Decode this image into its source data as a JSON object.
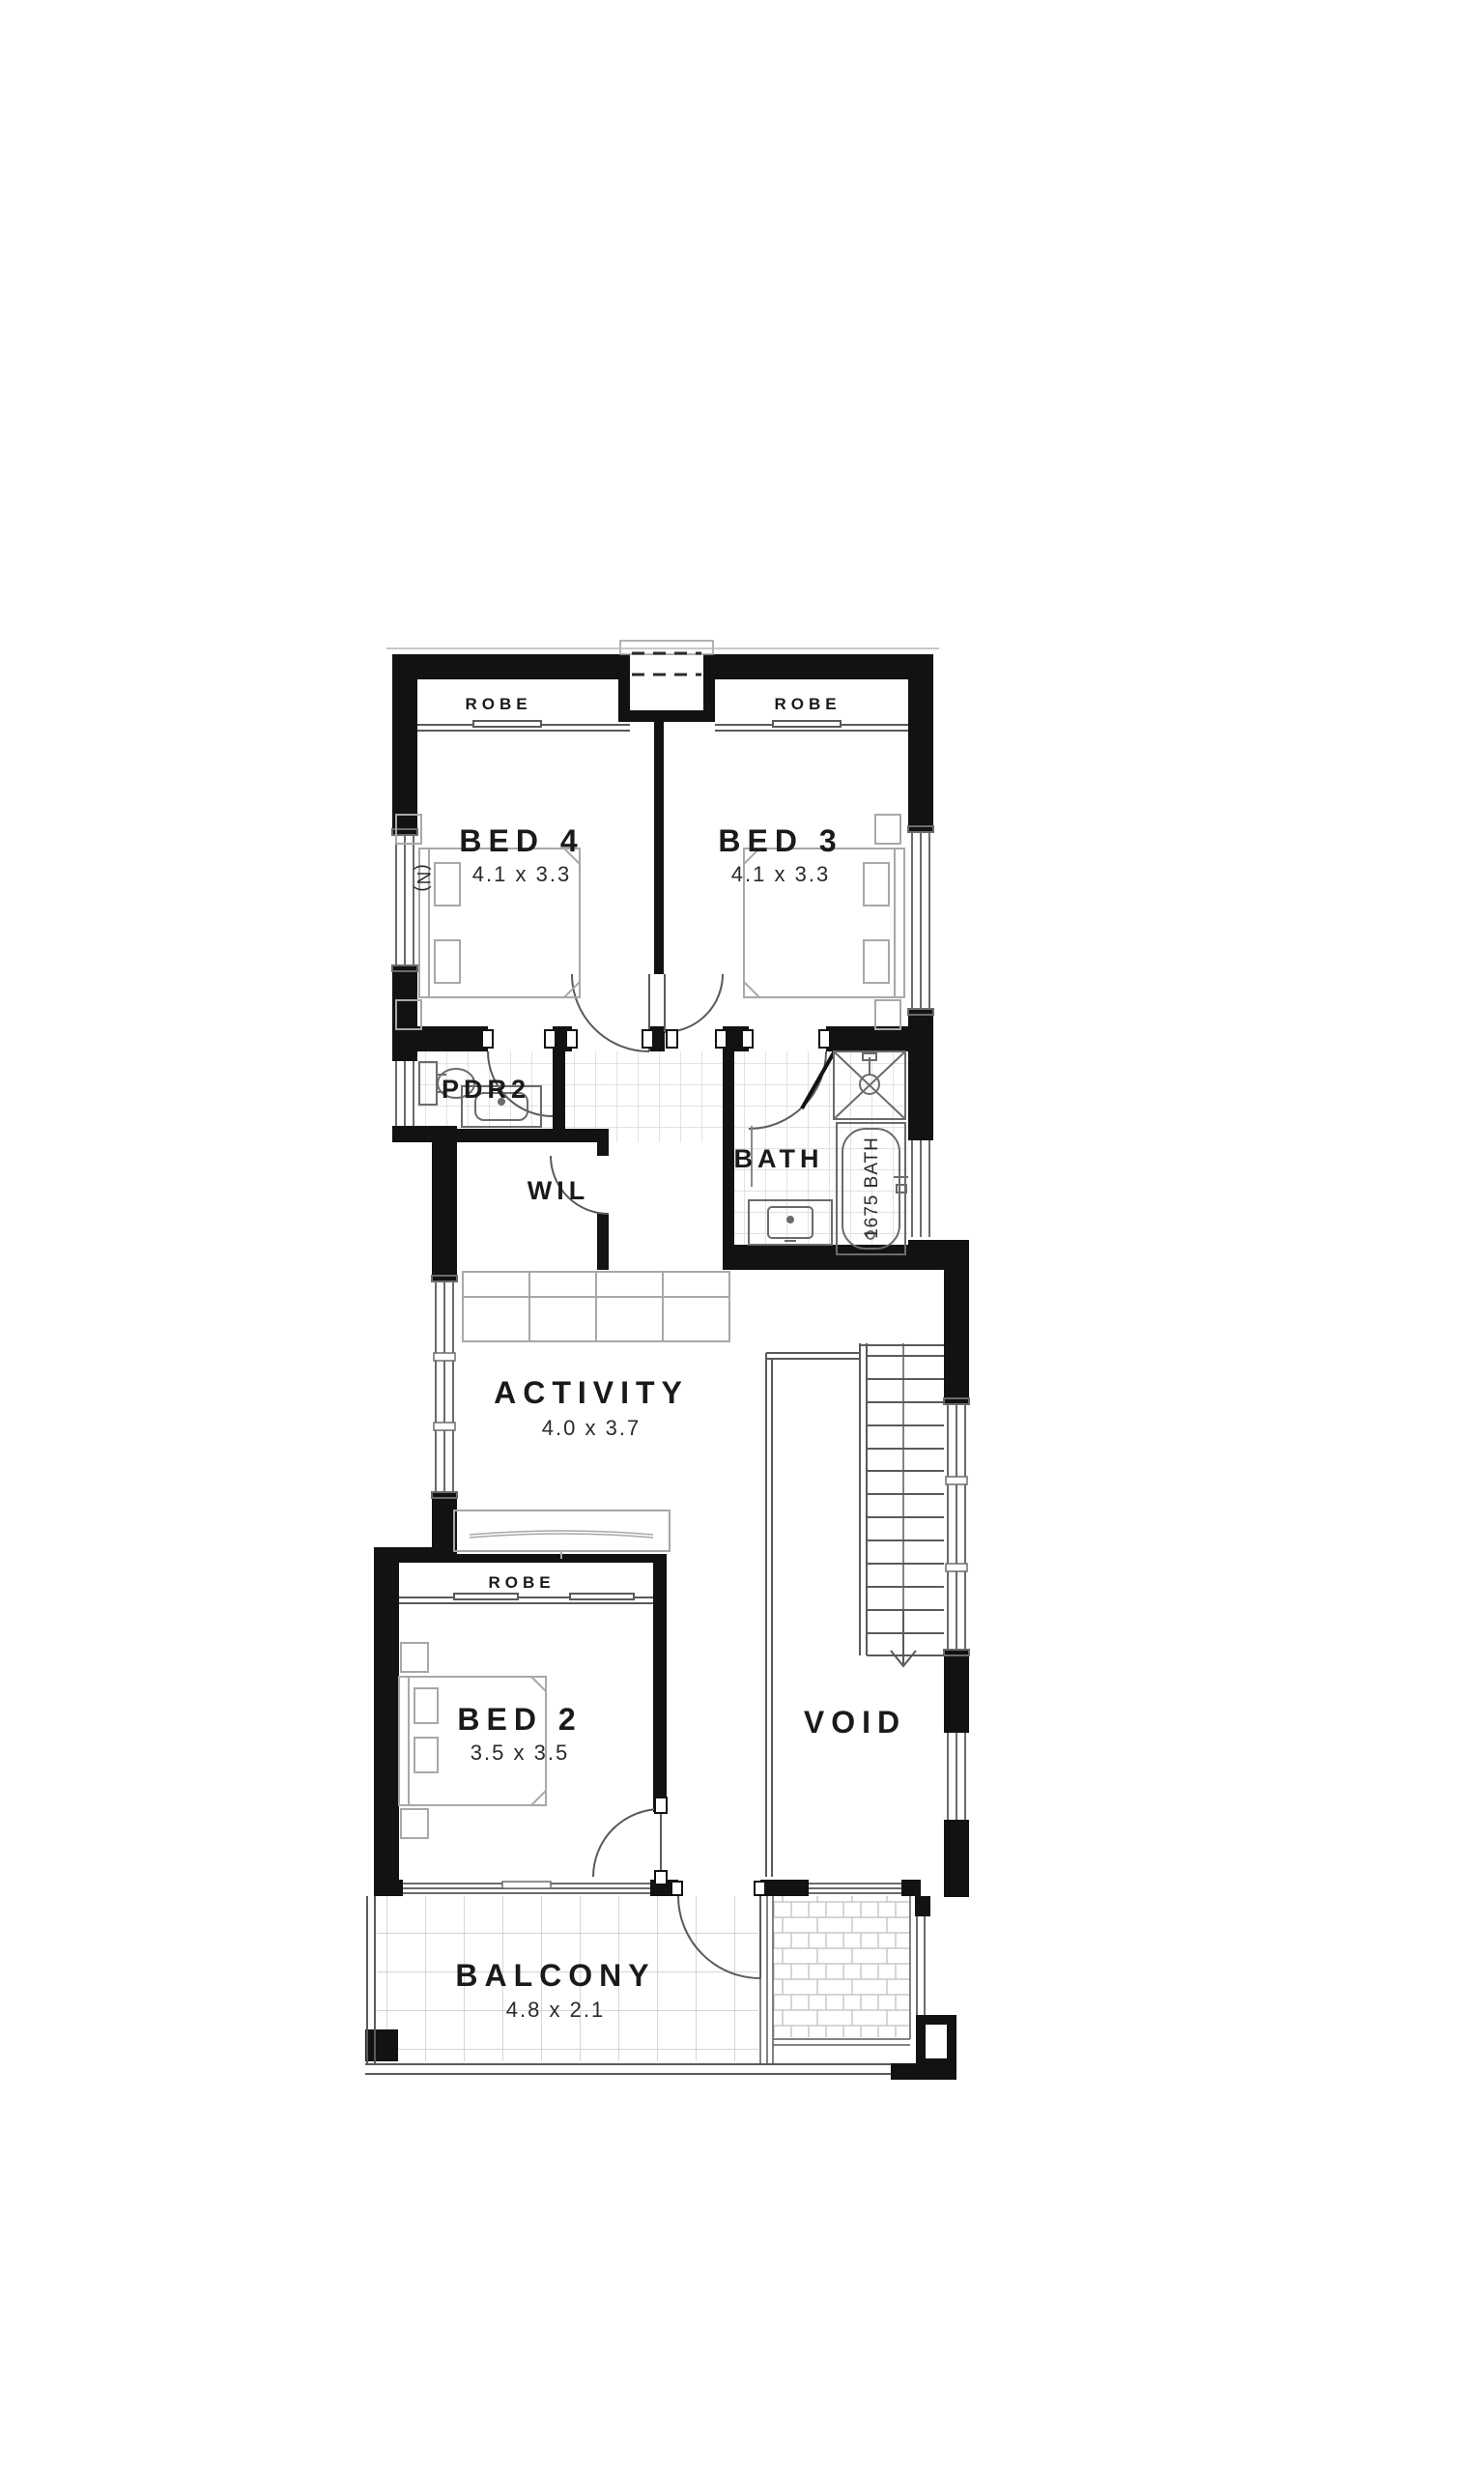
{
  "plan": {
    "type": "floor-plan",
    "rooms": {
      "bed4": {
        "label": "BED 4",
        "dims": "4.1 x 3.3"
      },
      "bed3": {
        "label": "BED 3",
        "dims": "4.1 x 3.3"
      },
      "bed2": {
        "label": "BED 2",
        "dims": "3.5 x 3.5"
      },
      "activity": {
        "label": "ACTIVITY",
        "dims": "4.0 x 3.7"
      },
      "balcony": {
        "label": "BALCONY",
        "dims": "4.8 x 2.1"
      },
      "void": {
        "label": "VOID"
      },
      "pdr2": {
        "label": "PDR2"
      },
      "wil": {
        "label": "WIL"
      },
      "bath": {
        "label": "BATH"
      }
    },
    "robes": {
      "top_left": "ROBE",
      "top_right": "ROBE",
      "bed2": "ROBE"
    },
    "fixtures": {
      "tub": "1675 BATH"
    },
    "annotations": {
      "north": "(N)"
    },
    "colors": {
      "wall": "#121212",
      "line": "#5a5a5a",
      "light_line": "#9a9a9a",
      "tile": "#cfcfcf",
      "text": "#1a1a1a",
      "background": "#ffffff"
    }
  }
}
